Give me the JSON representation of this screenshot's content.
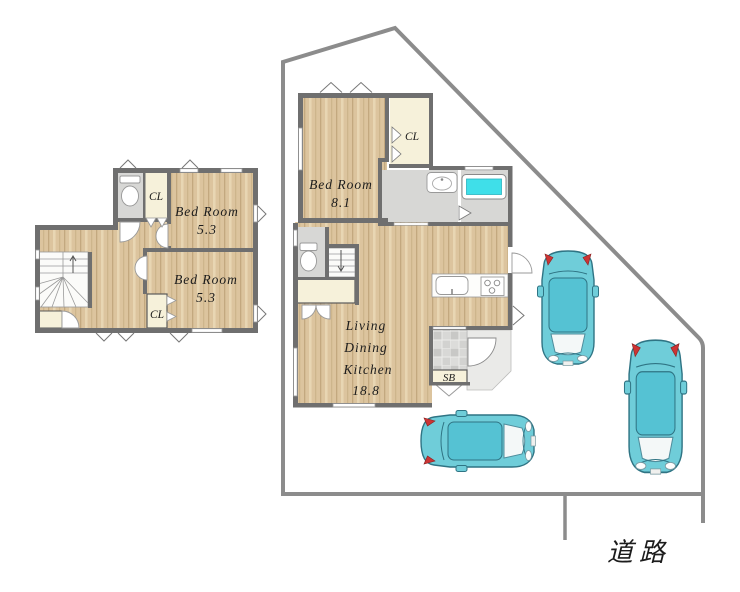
{
  "site": {
    "road_label": "道路"
  },
  "floor2": {
    "bedroom_top": {
      "name": "Bed Room",
      "size": "5.3"
    },
    "bedroom_bottom": {
      "name": "Bed Room",
      "size": "5.3"
    },
    "closet_top": "CL",
    "closet_bottom": "CL"
  },
  "floor1": {
    "bedroom": {
      "name": "Bed Room",
      "size": "8.1"
    },
    "closet": "CL",
    "ldk": {
      "line1": "Living",
      "line2": "Dining",
      "line3": "Kitchen",
      "size": "18.8"
    },
    "shoebox": "SB"
  },
  "colors": {
    "wood": "#dcc49e",
    "closet_cream": "#f6f1da",
    "wet_area_gray": "#d7d7d5",
    "wall": "#6f6f6f",
    "bathtub": "#3fdfe9",
    "car_body": "#6fcdd9",
    "boundary_line": "#8c8c8c"
  }
}
